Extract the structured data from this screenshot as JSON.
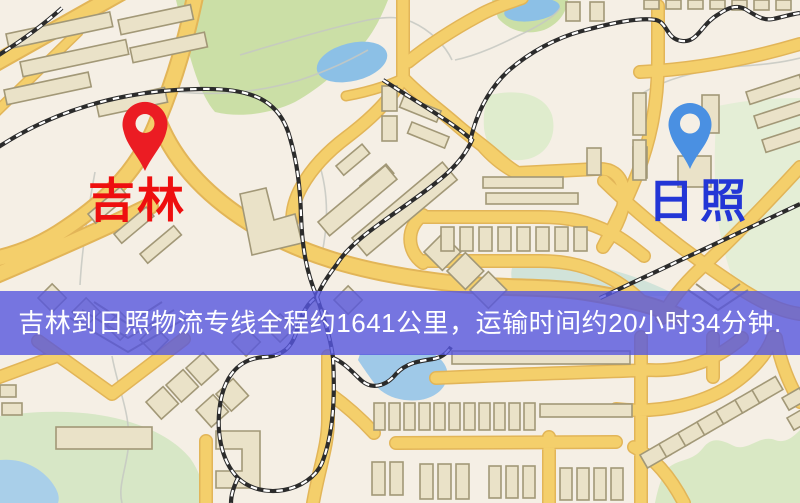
{
  "map": {
    "origin": {
      "label": "吉林",
      "label_color": "#ee0f0f",
      "pin_color": "#eb1c23"
    },
    "destination": {
      "label": "日照",
      "label_color": "#2336d6",
      "pin_color": "#4a90e2"
    },
    "palette": {
      "background": "#f5efe5",
      "road_fill": "#f4cf6b",
      "road_edge": "#e2b558",
      "building_fill": "#eae2c8",
      "building_stroke": "#a29877",
      "park_green": "#cbdfa6",
      "light_green": "#dfeccd",
      "water_blue": "#8cc0e6",
      "railway": "#2b2b2b",
      "contour_grey": "#c5c8c2"
    }
  },
  "banner": {
    "text": "吉林到日照物流专线全程约1641公里，运输时间约20小时34分钟.",
    "background_color": "#5656de",
    "text_color": "#ffffff"
  }
}
